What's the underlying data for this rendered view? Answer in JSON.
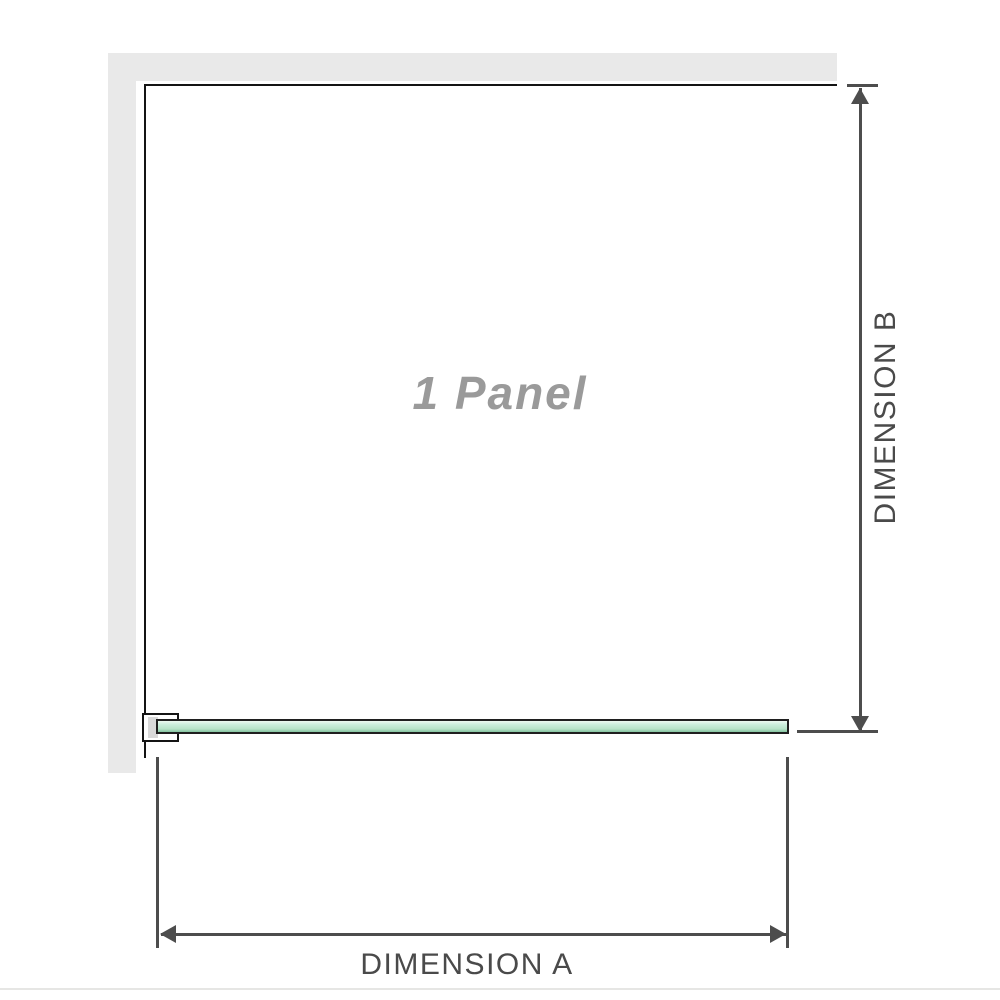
{
  "diagram": {
    "panel_label": "1 Panel",
    "dimension_a_label": "DIMENSION A",
    "dimension_b_label": "DIMENSION B"
  },
  "colors": {
    "wall": "#e9e9e9",
    "panel_border": "#141414",
    "panel_label_color": "#9a9a9a",
    "dim_line": "#4d4d4d",
    "dim_label_color": "#4a4a4a",
    "glass_border": "#1f1f1f",
    "glass_light": "#eef9f1",
    "glass_mid": "#cdeedd",
    "glass_deep": "#b7e3c8",
    "glass_edge": "#85c4a1",
    "bracket_fill": "#ffffff",
    "bracket_recess": "#d9d9d9",
    "footer_rule": "#e6e6e4"
  }
}
